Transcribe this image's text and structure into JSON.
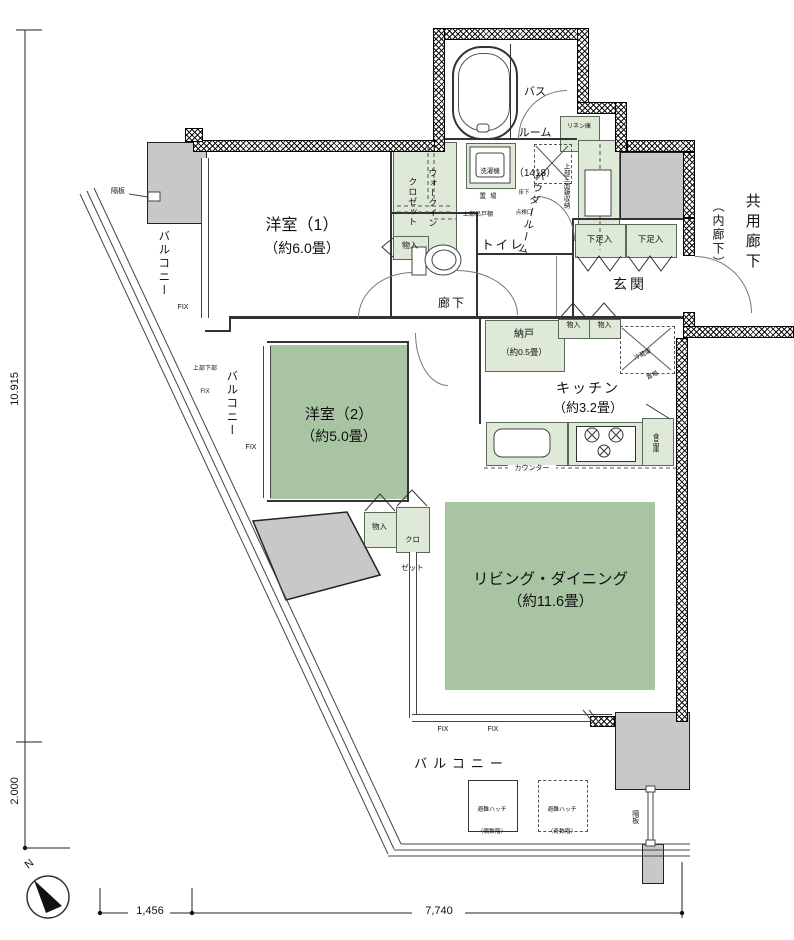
{
  "rooms": {
    "bath": {
      "name_l1": "バス",
      "name_l2": "ルーム",
      "size": "（1418）"
    },
    "western1": {
      "name": "洋室（1）",
      "size": "（約6.0畳）"
    },
    "western2": {
      "name": "洋室（2）",
      "size": "（約5.0畳）"
    },
    "living": {
      "name": "リビング・ダイニング",
      "size": "（約11.6畳）"
    },
    "kitchen": {
      "name": "キッチン",
      "size": "（約3.2畳）"
    },
    "storeroom": {
      "name": "納戸",
      "size": "（約0.5畳）"
    },
    "powder_room": "パウダールーム",
    "toilet": "トイレ",
    "hallway": "廊下",
    "entrance": "玄関",
    "wic_l1": "ウォークイン",
    "wic_l2": "クロゼット",
    "shared_corridor": "共用廊下",
    "shared_corridor_sub": "（内廊下）",
    "balcony": "バルコニー"
  },
  "fixtures": {
    "washer_l1": "洗濯機",
    "washer_l2": "置場",
    "linen": "リネン庫",
    "mirror_cabinet": "上部三面鏡収納",
    "inspection_l1": "床下",
    "inspection_l2": "点検口",
    "upper_cabinet": "上部吊戸棚",
    "shoe_box": "下足入",
    "storage": "物入",
    "closet_l1": "クロ",
    "closet_l2": "ゼット",
    "fridge_l1": "冷蔵庫",
    "fridge_l2": "置場",
    "pantry": "食品庫",
    "counter": "カウンター",
    "hatch_even_l1": "避難ハッチ",
    "hatch_even_l2": "（偶数階）",
    "hatch_odd_l1": "避難ハッチ",
    "hatch_odd_l2": "（奇数階）",
    "partition": "隔板",
    "fix": "FIX",
    "fix_upper_lower_l1": "上部下部",
    "fix_upper_lower_l2": "FIX"
  },
  "dimensions": {
    "height_upper": "10.915",
    "height_lower": "2.000",
    "width_left": "1,456",
    "width_right": "7,740"
  },
  "compass_north": "N",
  "colors": {
    "room_green": "#a9c4a2",
    "fixture_green": "#dfe9d8",
    "slab_grey": "#c8c8c8"
  }
}
